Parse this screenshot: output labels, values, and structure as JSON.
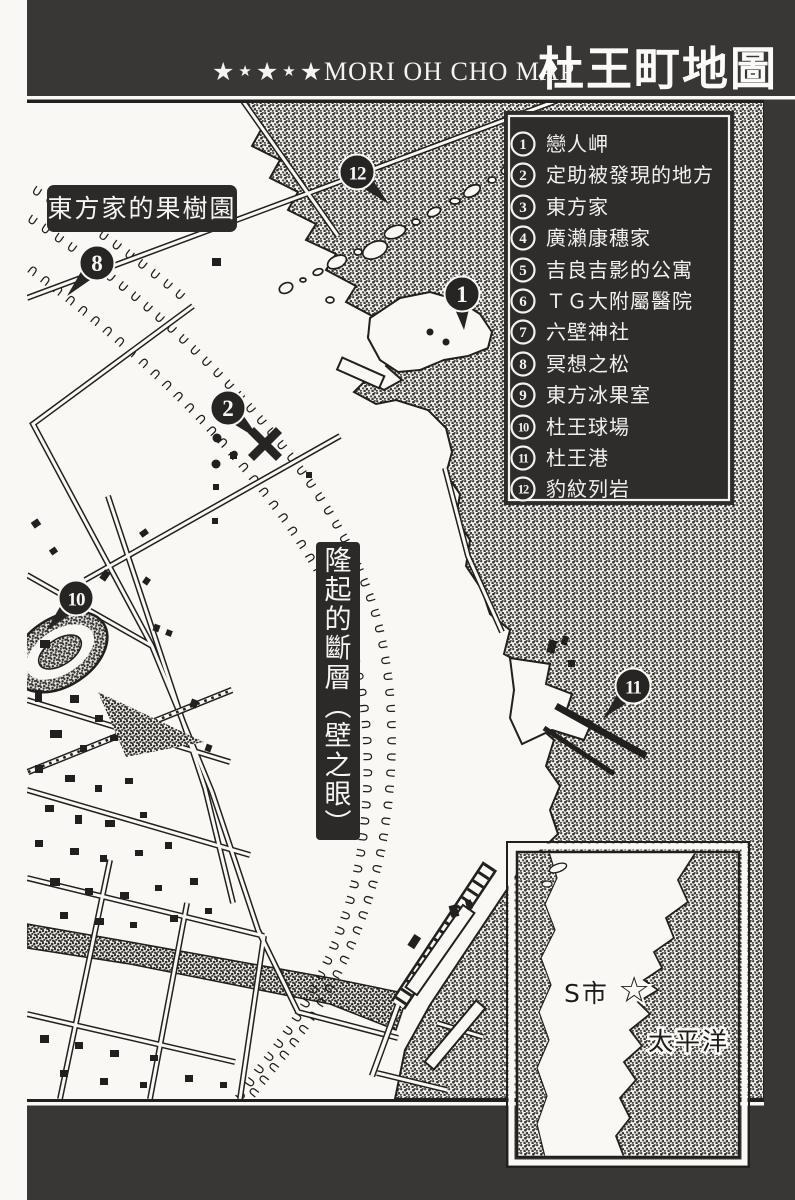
{
  "colors": {
    "panel": "#383736",
    "ink": "#21201e",
    "paper": "#f9f8f4",
    "legend_bg": "#2e2d2b"
  },
  "header": {
    "stars": [
      "★",
      "★",
      "★",
      "★",
      "★"
    ],
    "subtitle": "MORI OH CHO MAP",
    "title": "杜王町地圖"
  },
  "legend": {
    "items": [
      {
        "num": "1",
        "label": "戀人岬"
      },
      {
        "num": "2",
        "label": "定助被發現的地方"
      },
      {
        "num": "3",
        "label": "東方家"
      },
      {
        "num": "4",
        "label": "廣瀨康穗家"
      },
      {
        "num": "5",
        "label": "吉良吉影的公寓"
      },
      {
        "num": "6",
        "label": "ＴＧ大附屬醫院"
      },
      {
        "num": "7",
        "label": "六壁神社"
      },
      {
        "num": "8",
        "label": "冥想之松"
      },
      {
        "num": "9",
        "label": "東方冰果室"
      },
      {
        "num": "10",
        "label": "杜王球場"
      },
      {
        "num": "11",
        "label": "杜王港"
      },
      {
        "num": "12",
        "label": "豹紋列岩"
      }
    ]
  },
  "map_labels": {
    "orchard": "東方家的果樹園",
    "fault_vertical": "隆起的斷層（壁之眼）"
  },
  "markers": [
    {
      "num": "12",
      "x": 357,
      "y": 172,
      "dir": "se"
    },
    {
      "num": "1",
      "x": 462,
      "y": 294,
      "dir": "s"
    },
    {
      "num": "8",
      "x": 97,
      "y": 263,
      "dir": "sw"
    },
    {
      "num": "2",
      "x": 228,
      "y": 408,
      "dir": "se"
    },
    {
      "num": "10",
      "x": 76,
      "y": 598,
      "dir": "sw"
    },
    {
      "num": "11",
      "x": 633,
      "y": 686,
      "dir": "sw"
    }
  ],
  "inset": {
    "city_label": "S市",
    "star_symbol": "☆",
    "ocean_label": "太平洋"
  }
}
